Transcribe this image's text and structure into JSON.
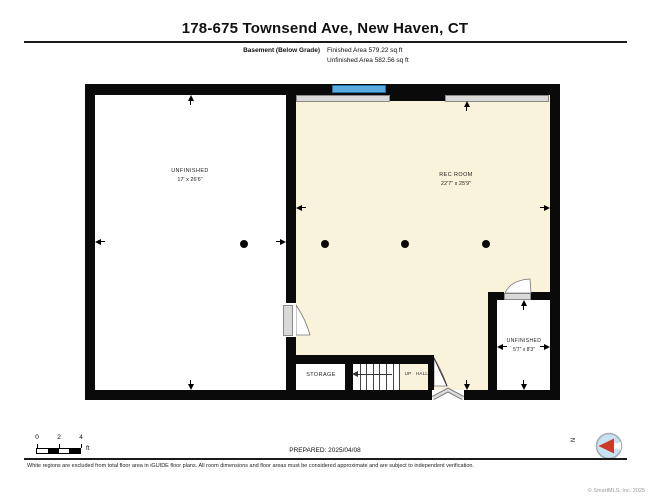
{
  "header": {
    "title": "178-675 Townsend Ave, New Haven, CT"
  },
  "area_summary": {
    "floor_label": "Basement (Below Grade)",
    "finished": "Finished Area 579.22 sq ft",
    "unfinished": "Unfinished Area 582.56 sq ft"
  },
  "floorplan": {
    "rooms": [
      {
        "name": "UNFINISHED",
        "dims": "17' x 26'6\""
      },
      {
        "name": "REC ROOM",
        "dims": "22'7\" x 25'9\""
      },
      {
        "name": "STORAGE",
        "dims": ""
      },
      {
        "name": "UNFINISHED",
        "dims": "5'7\" x 8'3\""
      }
    ],
    "stair_label": "UP",
    "hall_label": "HALL",
    "colors": {
      "finished_fill": "#FAF3DB",
      "unfinished_fill": "#FFFFFF",
      "wall": "#0A0A0A",
      "window": "#58ACDE",
      "annotation_gray": "#D9D9D9"
    }
  },
  "footer": {
    "scale_ticks": [
      "0",
      "2",
      "4"
    ],
    "scale_unit": "ft",
    "prepared": "PREPARED: 2025/04/08",
    "compass": "N",
    "copyright": "© SmartMLS, Inc. 2025"
  },
  "disclaimer": "White regions are excluded from total floor area in iGUIDE floor plans. All room dimensions and floor areas must be considered approximate and are subject to independent verification."
}
